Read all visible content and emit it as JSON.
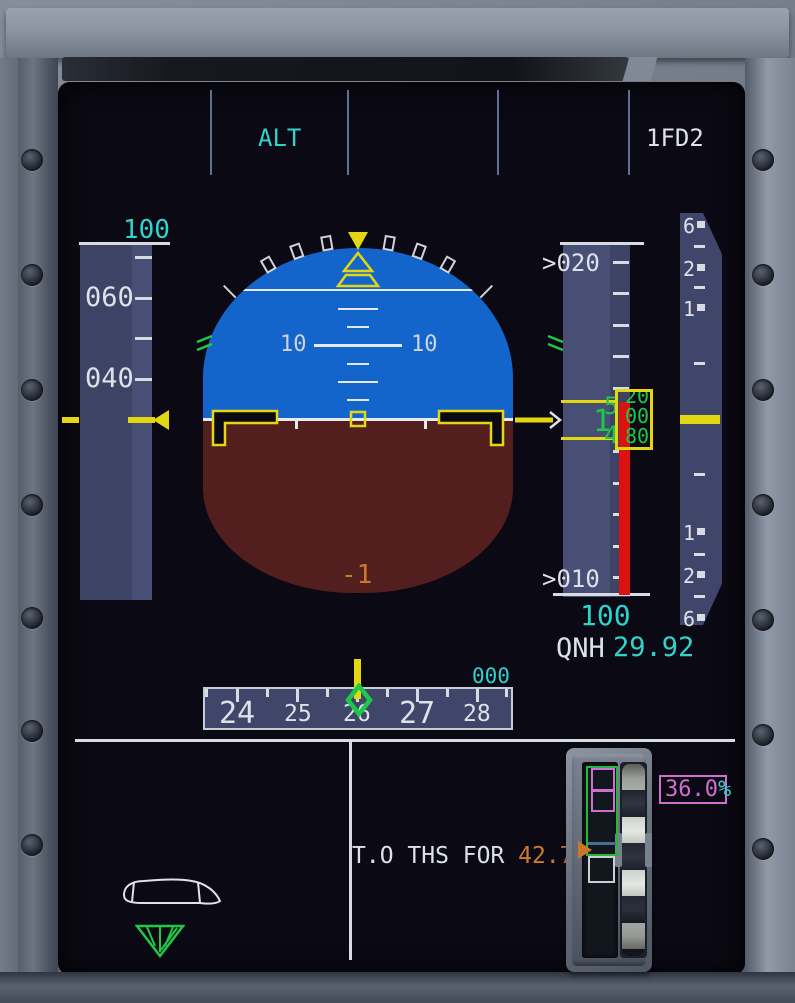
{
  "fma": {
    "active_mode": "ALT",
    "fd_id": "1FD2"
  },
  "speed": {
    "selected": "100",
    "tick_labels": [
      "060",
      "040"
    ]
  },
  "attitude": {
    "pitch_left": "10",
    "pitch_right": "10",
    "fpa": "-1"
  },
  "altitude": {
    "upper_label": ">020",
    "lower_label": ">010",
    "selected": "100",
    "qnh_label": "QNH",
    "qnh_value": "29.92",
    "window": {
      "thousands": "1",
      "hundreds_top": "5",
      "hundreds_bottom": "4",
      "drum": [
        "20",
        "00",
        "80",
        "60"
      ]
    }
  },
  "vs": {
    "top": [
      "6",
      "2",
      "1"
    ],
    "bottom": [
      "1",
      "2",
      "6"
    ]
  },
  "heading": {
    "selected": "000",
    "labels": [
      "24",
      "25",
      "26",
      "27",
      "28"
    ]
  },
  "trim_line": {
    "label": "T.O THS FOR ",
    "value": "42.7",
    "unit": "%"
  },
  "trim_gauge": {
    "value": "36.0",
    "unit": "%"
  },
  "colors": {
    "cyan": "#2ed3cb",
    "yellow": "#e3d714",
    "green": "#1dc947",
    "orange": "#cd7a30",
    "magenta": "#cf6fcf",
    "red": "#dc1211",
    "sky": "#1465cb",
    "ground": "#521f1e",
    "tape": "#3f466a"
  }
}
